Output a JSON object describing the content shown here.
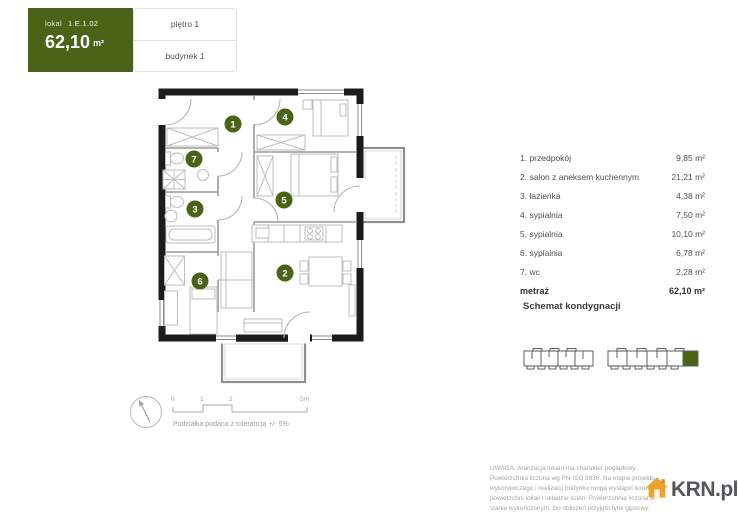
{
  "colors": {
    "green": "#4a6317",
    "wall": "#1c1c1c",
    "interior_line": "#9a9a9a",
    "furniture_line": "#bdbdbd",
    "logo_gray": "#55565a",
    "logo_orange": "#efa32b"
  },
  "header": {
    "lokal_label": "lokal",
    "lokal_id": "1.E.1.02",
    "area_value": "62,10",
    "area_unit": "m²",
    "floor": "piętro 1",
    "building": "budynek 1"
  },
  "rooms": [
    {
      "number": "1",
      "label": "1. przedpokój",
      "area": "9,85 m²"
    },
    {
      "number": "2",
      "label": "2. salon z aneksem kuchennym",
      "area": "21,21 m²"
    },
    {
      "number": "3",
      "label": "3. łazienka",
      "area": "4,38 m²"
    },
    {
      "number": "4",
      "label": "4. sypialnia",
      "area": "7,50 m²"
    },
    {
      "number": "5",
      "label": "5. sypialnia",
      "area": "10,10 m²"
    },
    {
      "number": "6",
      "label": "6. sypialnia",
      "area": "6,78 m²"
    },
    {
      "number": "7",
      "label": "7. wc",
      "area": "2,28 m²"
    }
  ],
  "total": {
    "label": "metraż",
    "area": "62,10 m²"
  },
  "schemat": {
    "title": "Schemat kondygnacji"
  },
  "scalebar": {
    "ticks": [
      "0",
      "1",
      "2",
      "5m"
    ],
    "tolerance": "Podziałka podana z tolerancją +/- 5%"
  },
  "footer": {
    "disclaimer": "UWAGA: Aranżacja lokalu ma charakter poglądowy. Powierzchnia liczona wg PN-ISO 9836. Na etapie projektu wykonawczego i realizacji budynku mogą wystąpić korekty w powierzchni lokali i układzie ścian. Powierzchnia liczona w stanie wykończonym. Do obliczeń przyjęto tynk gipsowy.",
    "logo_text": "KRN.pl"
  }
}
